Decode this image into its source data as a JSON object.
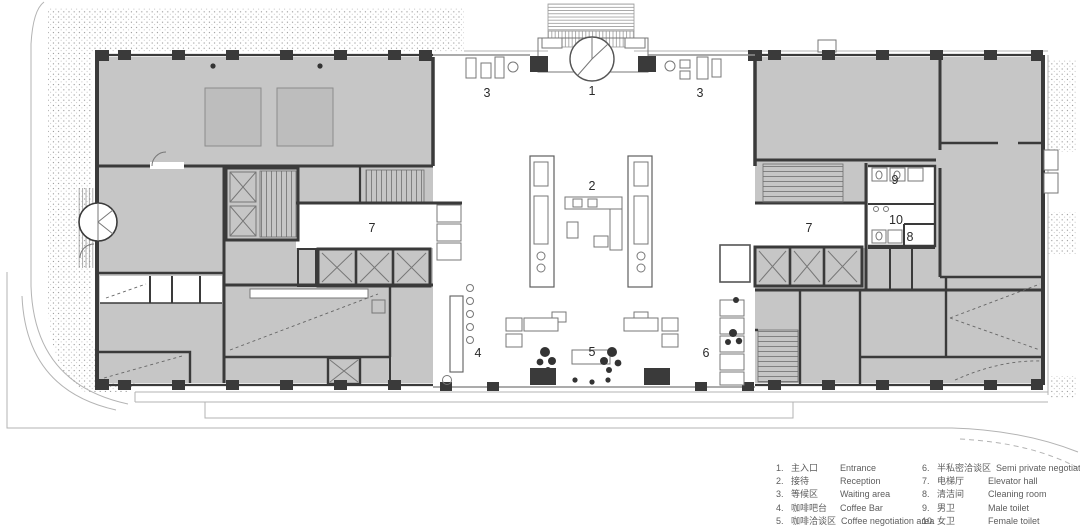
{
  "plan": {
    "title": "first-floor lobby plan",
    "labels": [
      {
        "text": "1"
      },
      {
        "text": "2"
      },
      {
        "text": "3"
      },
      {
        "text": "3"
      },
      {
        "text": "4"
      },
      {
        "text": "5"
      },
      {
        "text": "6"
      },
      {
        "text": "7"
      },
      {
        "text": "7"
      },
      {
        "text": "8"
      },
      {
        "text": "9"
      },
      {
        "text": "10"
      }
    ]
  },
  "legend": {
    "items_left": [
      {
        "num": "1.",
        "zh": "主入口",
        "en": "Entrance"
      },
      {
        "num": "2.",
        "zh": "接待",
        "en": "Reception"
      },
      {
        "num": "3.",
        "zh": "等候区",
        "en": "Waiting area"
      },
      {
        "num": "4.",
        "zh": "咖啡吧台",
        "en": "Coffee Bar"
      },
      {
        "num": "5.",
        "zh": "咖啡洽谈区",
        "en": "Coffee negotiation area"
      }
    ],
    "items_right": [
      {
        "num": "6.",
        "zh": "半私密洽谈区",
        "en": "Semi private negotiation area"
      },
      {
        "num": "7.",
        "zh": "电梯厅",
        "en": "Elevator hall"
      },
      {
        "num": "8.",
        "zh": "清洁间",
        "en": "Cleaning room"
      },
      {
        "num": "9.",
        "zh": "男卫",
        "en": "Male toilet"
      },
      {
        "num": "10.",
        "zh": "女卫",
        "en": "Female toilet"
      }
    ]
  },
  "colors": {
    "wall": "#3a3a3a",
    "room_fill": "#c6c6c6",
    "site_line": "#b3b3b3",
    "label_text": "#2a2a2a",
    "legend_text": "#5d5d5d"
  }
}
